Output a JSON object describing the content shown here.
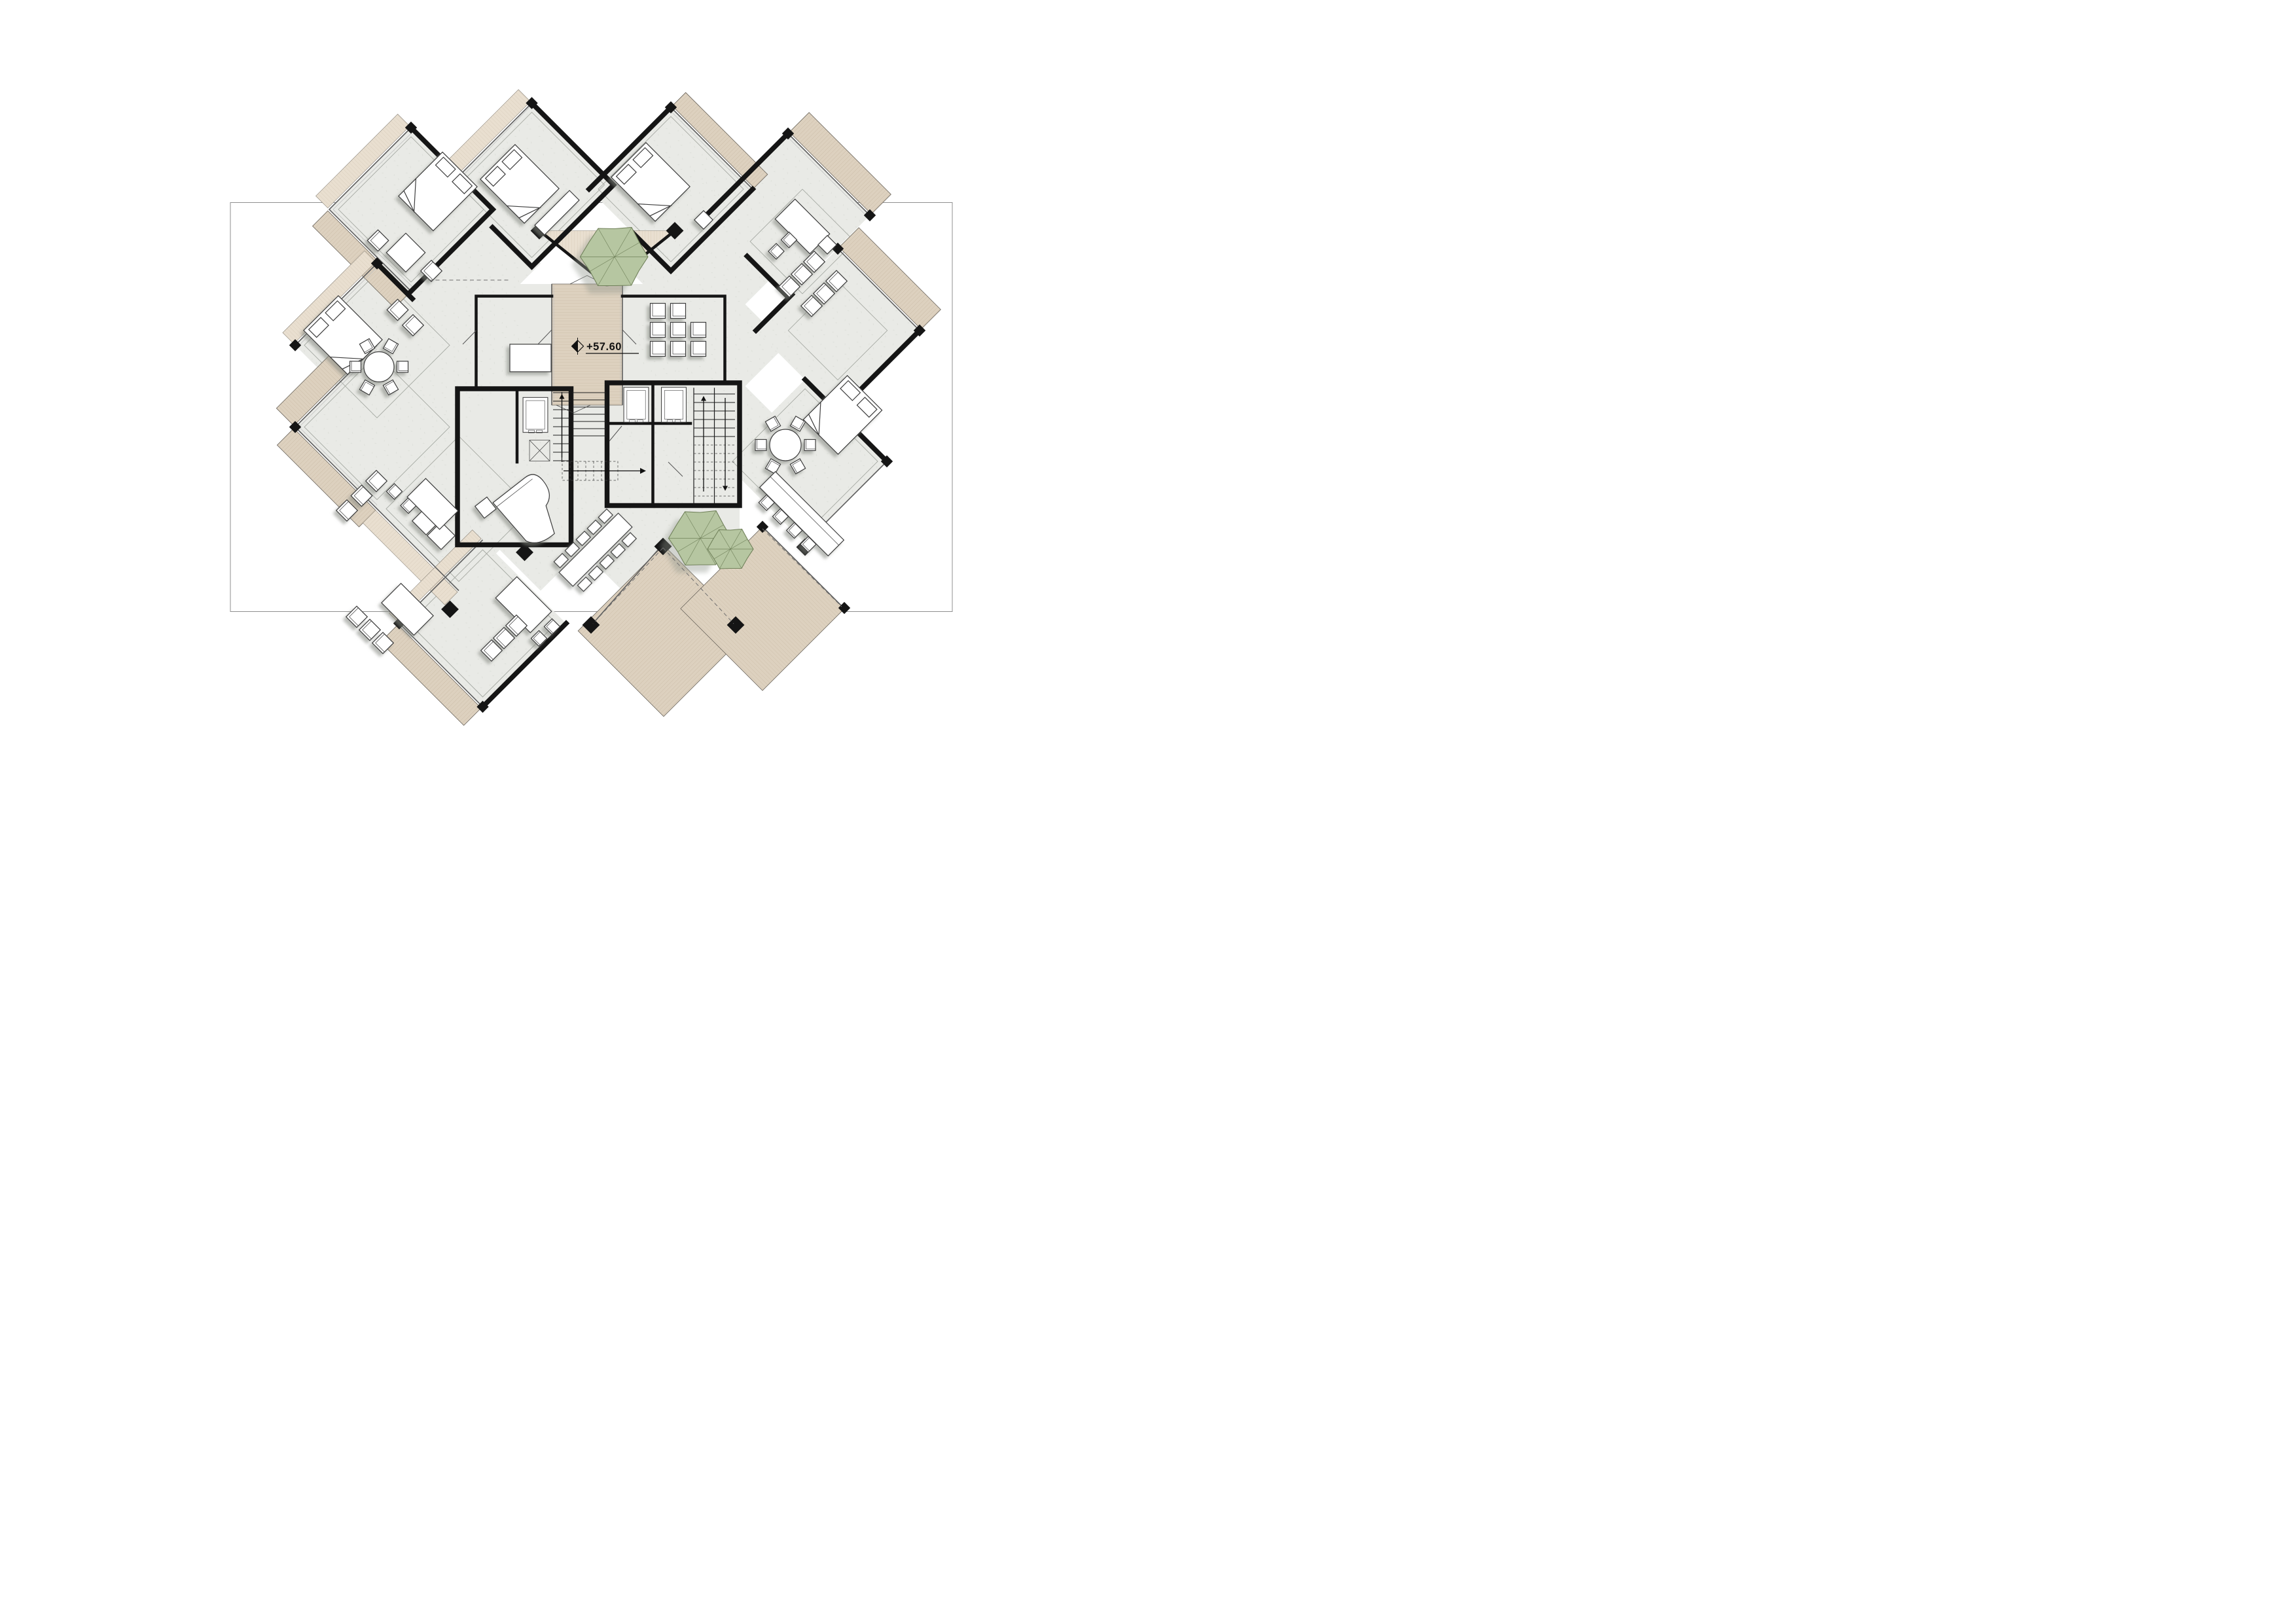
{
  "document": {
    "kind": "architectural floor plan",
    "sheet_background": "white"
  },
  "annotations": {
    "elevation_label": "+57.60"
  },
  "palette": {
    "boundary": "#8f8f8f",
    "floor": "#e9eae6",
    "floor_fleck": "#d9dbd5",
    "wall": "#151515",
    "glass_dark": "#5f5f5f",
    "glass_light": "#bdbdbd",
    "deck": "#ddd1bf",
    "deck_line": "#c2b19a",
    "deck_light": "#e9dfd0",
    "deck_light_line": "#cfc2ad",
    "tree": "#b6c6a1",
    "tree_line": "#70815a",
    "furniture": "#ffffff",
    "furniture_line": "#3d3d3d",
    "dash": "#6f6f6f"
  },
  "icons": {
    "level_marker": "survey-level-diamond",
    "trees": [
      "courtyard-tree",
      "terrace-tree-large",
      "terrace-tree-small"
    ]
  }
}
